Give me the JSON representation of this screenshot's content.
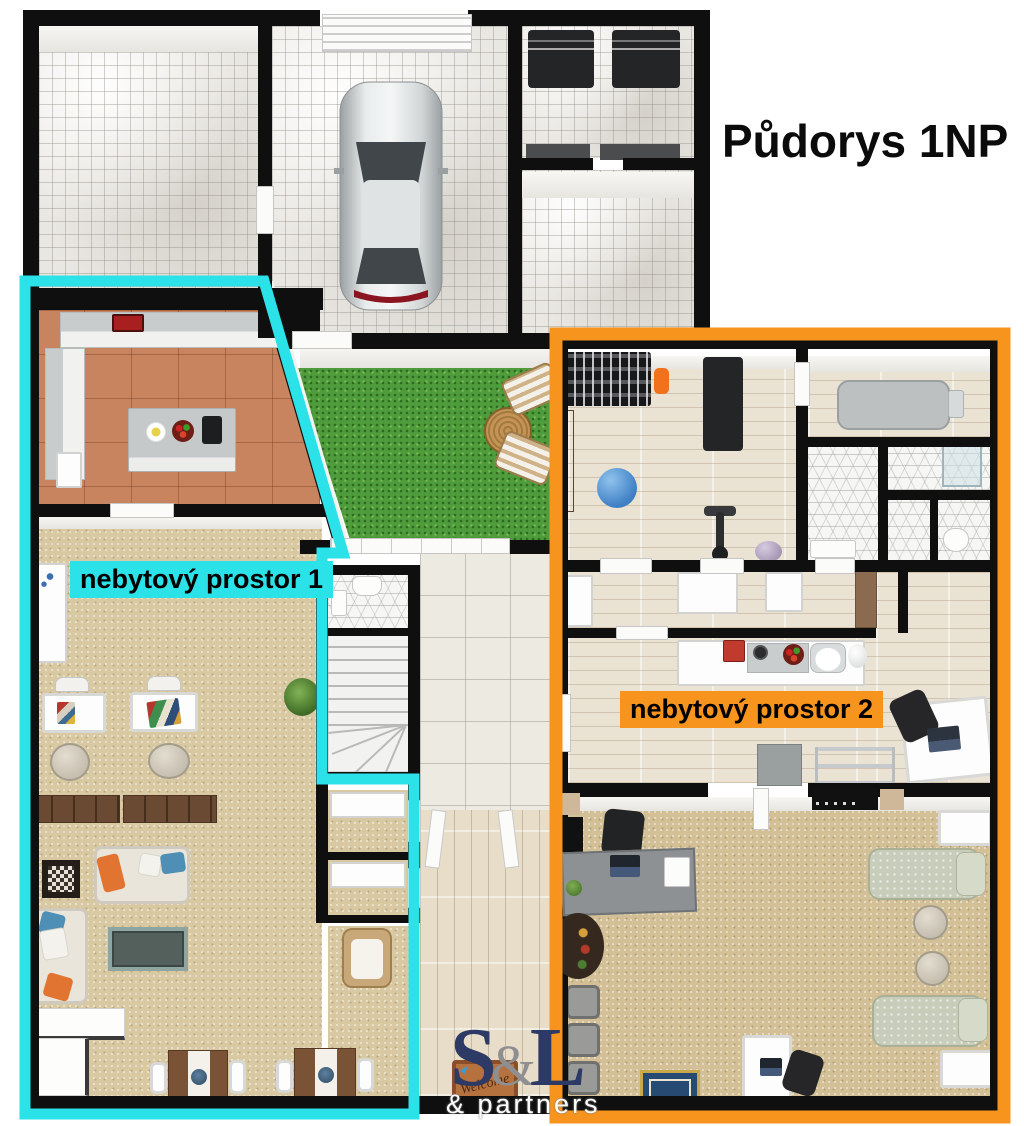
{
  "title": "Půdorys 1NP",
  "zone1": {
    "label": "nebytový prostor 1"
  },
  "zone2": {
    "label": "nebytový prostor 2"
  },
  "watermark": {
    "s": "S",
    "amp": "&",
    "l": "L",
    "subtitle": "& partners"
  },
  "doormat": {
    "text": "Welcome"
  },
  "colors": {
    "wall": "#0F0F0F",
    "zone1": "#2BE2E8",
    "zone2": "#F7941D",
    "grass": "#4F9C3C",
    "terracotta": "#C8845F",
    "carpet": "#D9C9A2",
    "logo_navy": "#2D3A66"
  }
}
